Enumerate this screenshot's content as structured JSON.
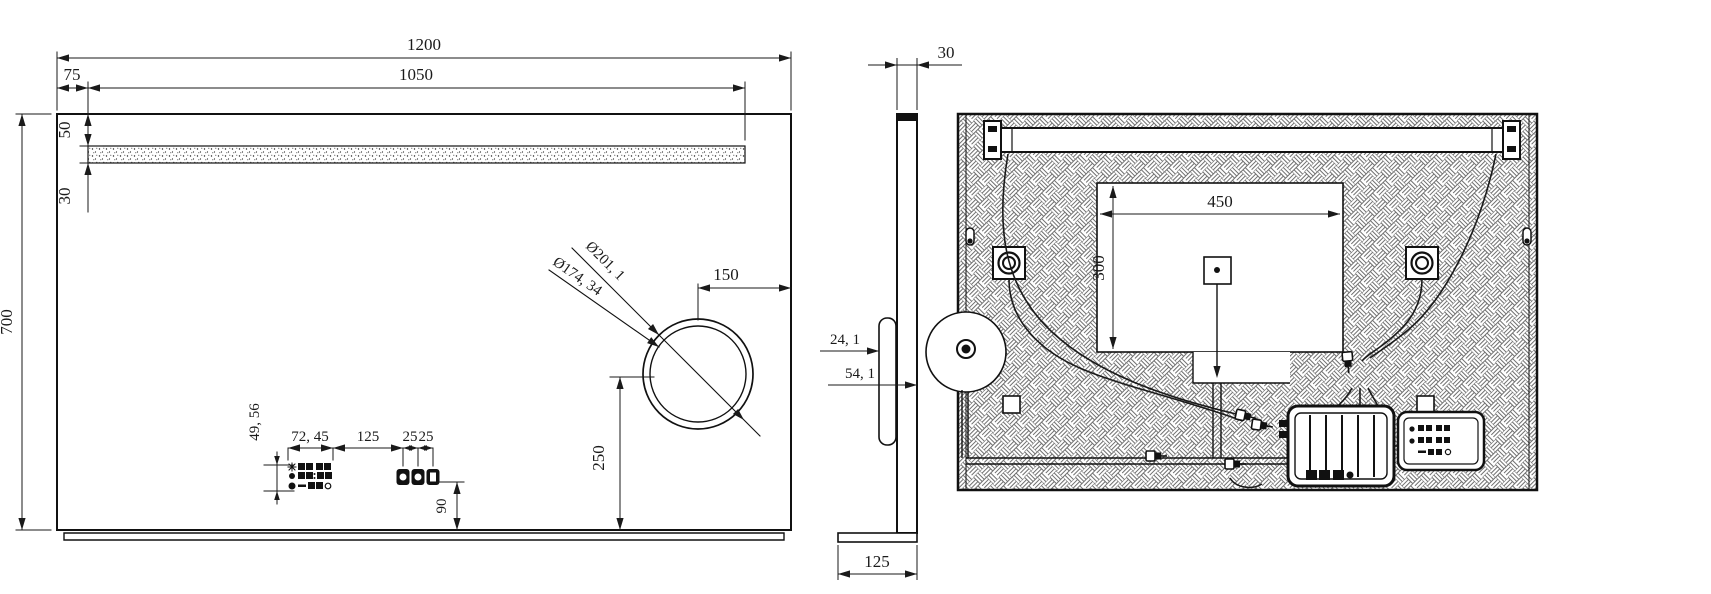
{
  "front_view": {
    "overall_width": "1200",
    "led_offset_left": "75",
    "led_length": "1050",
    "led_offset_top": "50",
    "led_strip_height": "30",
    "overall_height": "700",
    "magnifier_dia_outer": "Ø201, 1",
    "magnifier_dia_inner": "Ø174, 34",
    "magnifier_offset_right": "150",
    "magnifier_offset_bottom": "250",
    "display_height": "49, 56",
    "display_width": "72, 45",
    "display_button_gap": "125",
    "button_pitch_a": "25",
    "button_pitch_b": "25",
    "buttons_offset_bottom": "90"
  },
  "side_view": {
    "mirror_thickness": "30",
    "magnifier_depth": "24, 1",
    "total_depth": "54, 1",
    "base_depth": "125"
  },
  "back_view": {
    "niche_width": "450",
    "niche_height": "300"
  }
}
